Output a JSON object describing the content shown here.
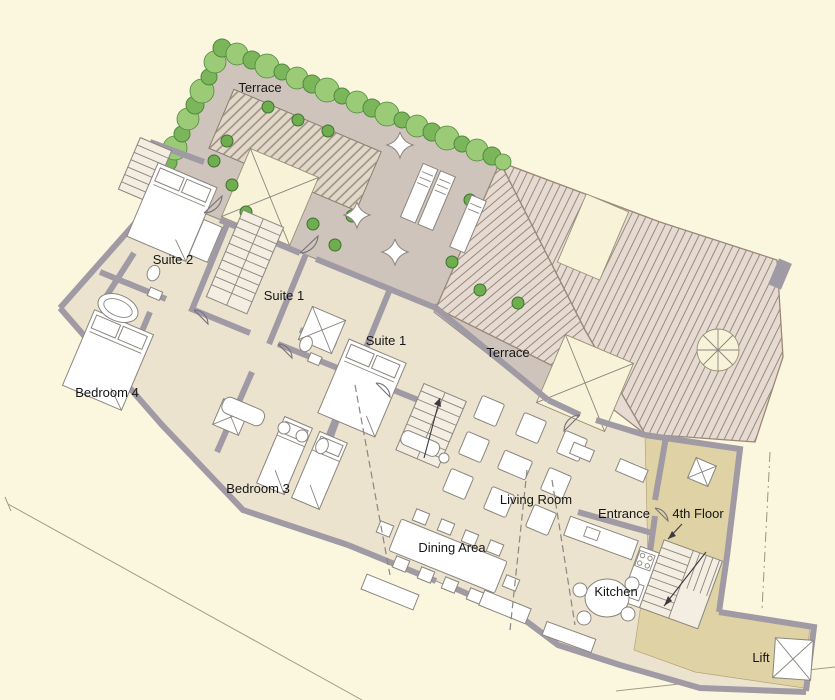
{
  "plan": {
    "type": "architectural-floor-plan",
    "floor": "4th Floor",
    "rooms": [
      {
        "id": "terrace-top",
        "label": "Terrace"
      },
      {
        "id": "suite-2",
        "label": "Suite 2"
      },
      {
        "id": "suite-1-west",
        "label": "Suite 1"
      },
      {
        "id": "suite-1-east",
        "label": "Suite 1"
      },
      {
        "id": "terrace-mid",
        "label": "Terrace"
      },
      {
        "id": "bedroom-4",
        "label": "Bedroom 4"
      },
      {
        "id": "bedroom-3",
        "label": "Bedroom 3"
      },
      {
        "id": "living-room",
        "label": "Living Room"
      },
      {
        "id": "entrance",
        "label": "Entrance"
      },
      {
        "id": "fourth-floor",
        "label": "4th Floor"
      },
      {
        "id": "dining-area",
        "label": "Dining Area"
      },
      {
        "id": "kitchen",
        "label": "Kitchen"
      },
      {
        "id": "lift",
        "label": "Lift"
      }
    ],
    "colors": {
      "background": "#FBF7DE",
      "interior": "#EBE3CE",
      "terrace": "#CEC4BC",
      "roof_base": "#E5DBD2",
      "roof_line": "#9C8878",
      "landing": "#DFD2A4",
      "wall": "#A09AA4",
      "wall_dark": "#6F6A73",
      "hedge": "#7CB65A",
      "hedge_dark": "#4E8A3C",
      "furniture": "#FFFFFF",
      "furniture_line": "#8A857E",
      "skylight": "#F7F2D8"
    }
  }
}
